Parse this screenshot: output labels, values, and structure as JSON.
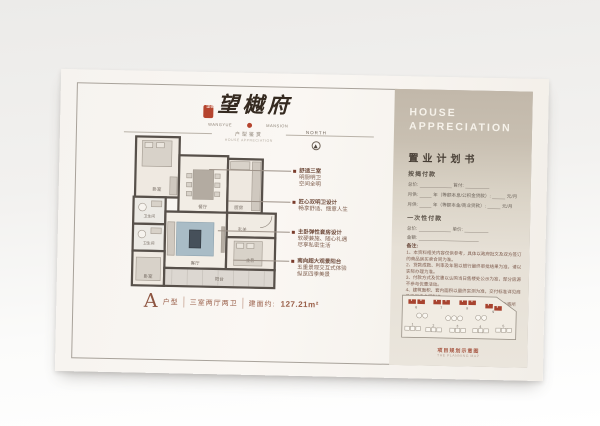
{
  "brand": {
    "seal_text": "望樾",
    "name": "望樾府",
    "name_sub_left": "WANGYUE",
    "name_sub_right": "MANSION",
    "divider_cn": "户型鉴赏",
    "divider_en": "HOUSE APPRECIATION"
  },
  "north_label": "NORTH",
  "annotations": [
    {
      "lines": [
        "舒适三室",
        "明厨明卫",
        "空间全明"
      ]
    },
    {
      "lines": [
        "匠心双明卫设计",
        "畅享舒适、惬意人生"
      ]
    },
    {
      "lines": [
        "主卧弹性套房设计",
        "软硬兼施、随心礼遇",
        "尽享私密生活"
      ]
    },
    {
      "lines": [
        "南向超大观景阳台",
        "五重景观交互式体验",
        "纵览四季美景"
      ]
    }
  ],
  "floorplan": {
    "rooms": [
      "卧室",
      "餐厅",
      "厨房",
      "玄关",
      "卫生间",
      "卫生间",
      "客厅",
      "主卧",
      "卧室",
      "阳台"
    ]
  },
  "caption": {
    "type_letter": "A",
    "type_label": "户型",
    "layout": "三室两厅两卫",
    "area_label": "建面约:",
    "area_value": "127.21m²"
  },
  "panel": {
    "header_line1": "HOUSE",
    "header_line2": "APPRECIATION",
    "title": "置业计划书",
    "mortgage": {
      "title": "按揭付款",
      "total_label": "总价:",
      "down_label": "首付:",
      "monthly_label": "月供:",
      "plan1_mid": "年（等额本息/公积金贷款）:",
      "plan2_mid": "年（等额本金/商业贷款）:",
      "unit": "元/月"
    },
    "onetime": {
      "title": "一次性付款",
      "total_label": "总价:",
      "unit_label": "单价:",
      "amount_label": "金额:"
    },
    "notes": {
      "title": "备注:",
      "items": [
        "1、本资料相关内容仅供参考，具体以政府批文及双方签订的商品房买卖合同为准。",
        "2、贷款成数、利率及年限以银行最终审批结果为准，请以实际办理为准。",
        "3、付款方式及优惠以认购当日售楼处公示为准，部分房源不参与优惠活动。",
        "4、建筑面积、套内面积以最终实测为准，交付标准详见商品房买卖合同附件。",
        "5、本计划书不作为要约或承诺，最终解释权归开发商所有。"
      ]
    },
    "siteplan": {
      "caption_cn": "项目规划示意图",
      "caption_en": "THE PLANNING MAP",
      "building_numbers": [
        "1",
        "2",
        "3",
        "4",
        "5",
        "6",
        "7",
        "8",
        "9"
      ]
    }
  }
}
